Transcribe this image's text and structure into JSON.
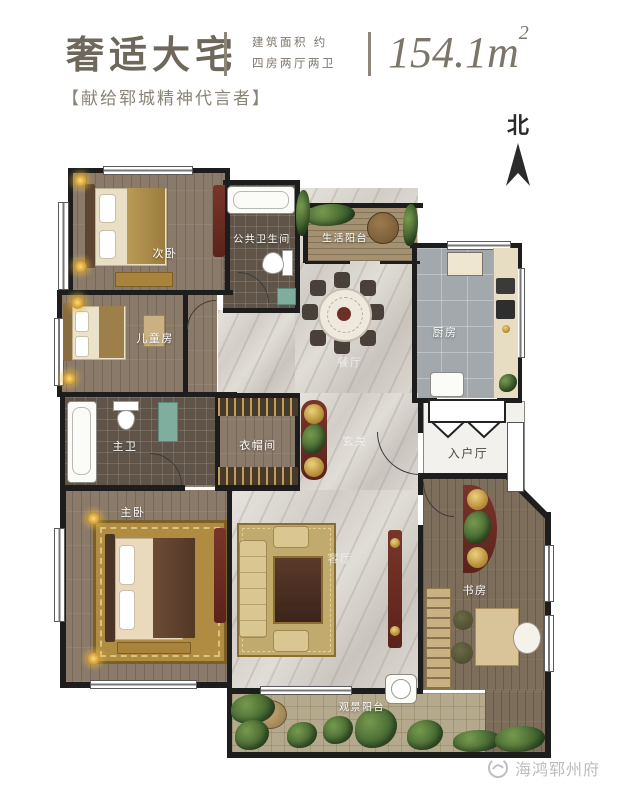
{
  "header": {
    "title": "奢适大宅",
    "spec_line1": "建筑面积  约",
    "spec_line2": "四房两厅两卫",
    "area_value": "154.1m",
    "area_superscript": "2",
    "tagline": "【献给郓城精神代言者】"
  },
  "compass": {
    "north_label": "北"
  },
  "rooms": {
    "secondary_bedroom": {
      "label": "次卧"
    },
    "public_bathroom": {
      "label": "公共卫生间"
    },
    "life_balcony": {
      "label": "生活阳台"
    },
    "kitchen": {
      "label": "厨房"
    },
    "dining_room": {
      "label": "餐厅"
    },
    "children_room": {
      "label": "儿童房"
    },
    "master_bathroom": {
      "label": "主卫"
    },
    "cloakroom": {
      "label": "衣帽间"
    },
    "foyer": {
      "label": "玄关"
    },
    "entry_hall": {
      "label": "入户厅"
    },
    "master_bedroom": {
      "label": "主卧"
    },
    "living_room": {
      "label": "客厅"
    },
    "study": {
      "label": "书房"
    },
    "view_balcony": {
      "label": "观景阳台"
    }
  },
  "watermark": {
    "brand_name": "海鸿郓州府"
  },
  "colors": {
    "wall": "#1d1d1d",
    "marble": "#d8d4cd",
    "wood": "#8a7a6a",
    "accent_red": "#6d3026",
    "accent_gold": "#b08c42",
    "title_text": "#6e675c"
  }
}
